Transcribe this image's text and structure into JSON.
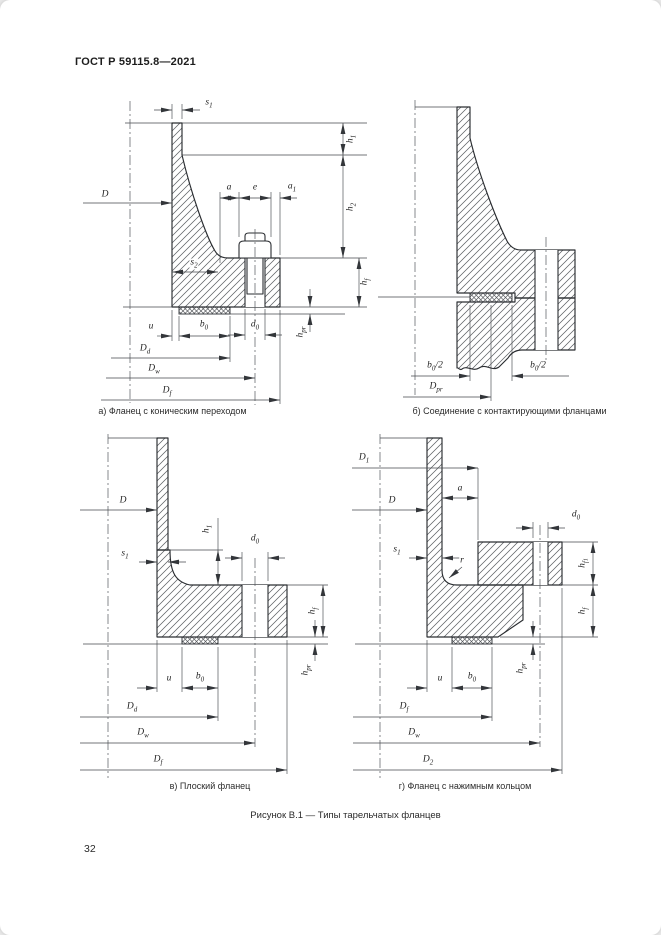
{
  "page": {
    "header": "ГОСТ Р 59115.8—2021",
    "figure_caption": "Рисунок В.1 — Типы тарельчатых фланцев",
    "page_number": "32"
  },
  "panels": {
    "a": {
      "caption": "а) Фланец с коническим переходом",
      "labels": {
        "s1": {
          "main": "s",
          "sub": "1"
        },
        "D": {
          "main": "D"
        },
        "a": {
          "main": "a"
        },
        "e": {
          "main": "e"
        },
        "a1": {
          "main": "a",
          "sub": "1"
        },
        "h1": {
          "main": "h",
          "sub": "1"
        },
        "h2": {
          "main": "h",
          "sub": "2"
        },
        "s2": {
          "main": "s",
          "sub": "2"
        },
        "hf": {
          "main": "h",
          "sub": "f"
        },
        "u": {
          "main": "u"
        },
        "b0": {
          "main": "b",
          "sub": "0"
        },
        "d0": {
          "main": "d",
          "sub": "0"
        },
        "hpr": {
          "main": "h",
          "sub": "pr"
        },
        "Dd": {
          "main": "D",
          "sub": "d"
        },
        "Dw": {
          "main": "D",
          "sub": "w"
        },
        "Df": {
          "main": "D",
          "sub": "f"
        }
      }
    },
    "b": {
      "caption": "б) Соединение с контактирующими фланцами",
      "labels": {
        "b02l": {
          "main": "b",
          "sub": "0",
          "suffix": "/2"
        },
        "b02r": {
          "main": "b",
          "sub": "0",
          "suffix": "/2"
        },
        "Dpr": {
          "main": "D",
          "sub": "pr"
        }
      }
    },
    "v": {
      "caption": "в) Плоский фланец",
      "labels": {
        "D": {
          "main": "D"
        },
        "h1": {
          "main": "h",
          "sub": "1"
        },
        "s1": {
          "main": "s",
          "sub": "1"
        },
        "d0": {
          "main": "d",
          "sub": "0"
        },
        "hf": {
          "main": "h",
          "sub": "f"
        },
        "hpr": {
          "main": "h",
          "sub": "pr"
        },
        "u": {
          "main": "u"
        },
        "b0": {
          "main": "b",
          "sub": "0"
        },
        "Dd": {
          "main": "D",
          "sub": "d"
        },
        "Dw": {
          "main": "D",
          "sub": "w"
        },
        "Df": {
          "main": "D",
          "sub": "f"
        }
      }
    },
    "g": {
      "caption": "г) Фланец с нажимным кольцом",
      "labels": {
        "D1": {
          "main": "D",
          "sub": "1"
        },
        "D": {
          "main": "D"
        },
        "a": {
          "main": "a"
        },
        "s1": {
          "main": "s",
          "sub": "1"
        },
        "r": {
          "main": "r"
        },
        "d0": {
          "main": "d",
          "sub": "0"
        },
        "hf1": {
          "main": "h",
          "sub": "f",
          "sub2": "1"
        },
        "hf": {
          "main": "h",
          "sub": "f"
        },
        "hpr": {
          "main": "h",
          "sub": "pr"
        },
        "u": {
          "main": "u"
        },
        "b0": {
          "main": "b",
          "sub": "0"
        },
        "Df": {
          "main": "D",
          "sub": "f"
        },
        "Dw": {
          "main": "D",
          "sub": "w"
        },
        "D2": {
          "main": "D",
          "sub": "2"
        }
      }
    }
  }
}
